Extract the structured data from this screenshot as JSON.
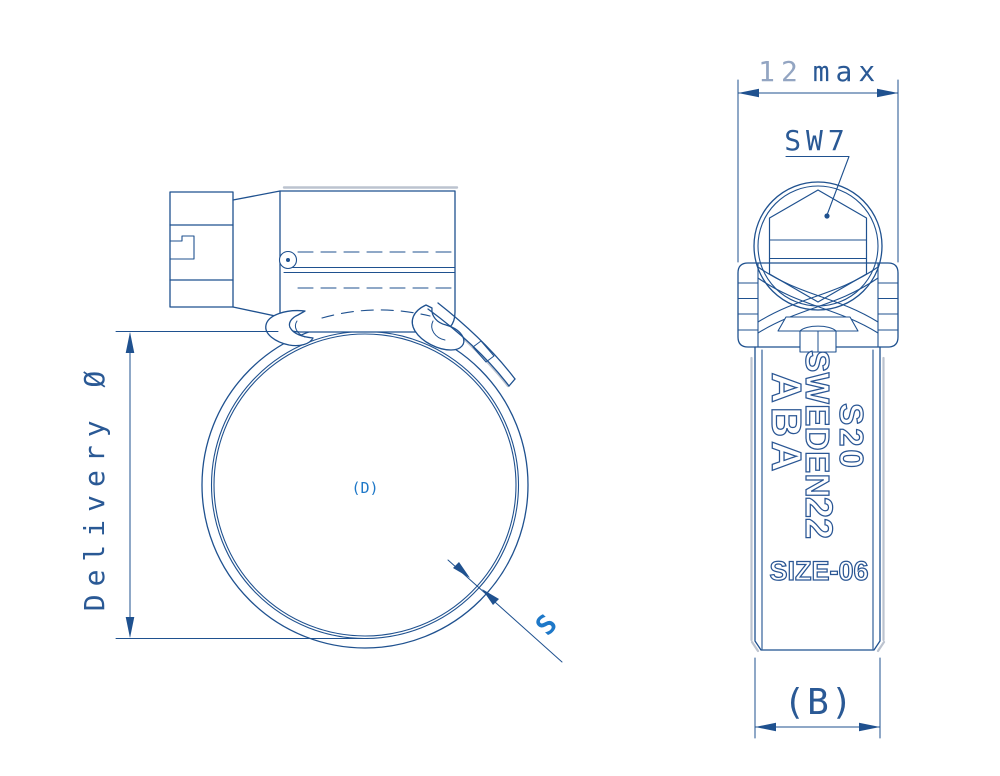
{
  "drawing": {
    "type": "hose-clamp technical drawing, two views",
    "colors": {
      "line": "#1f518f",
      "label_text": "#2a5995",
      "muted_text": "#93a5c2",
      "accent_text": "#1e78c8",
      "shadow": "#bcc3cf",
      "background": "#ffffff"
    }
  },
  "labels": {
    "side_view": {
      "diameter": "Delivery Ø",
      "inner_diameter_ref": "(D)",
      "band_thickness": "S"
    },
    "front_view": {
      "width_value": "12",
      "width_suffix": "max",
      "hex_key": "SW7",
      "band_width_ref": "(B)"
    },
    "band_marking": {
      "brand": "ABA",
      "country": "SWEDEN",
      "series": "S20",
      "size_number": "22",
      "size_code": "SIZE-06"
    }
  }
}
